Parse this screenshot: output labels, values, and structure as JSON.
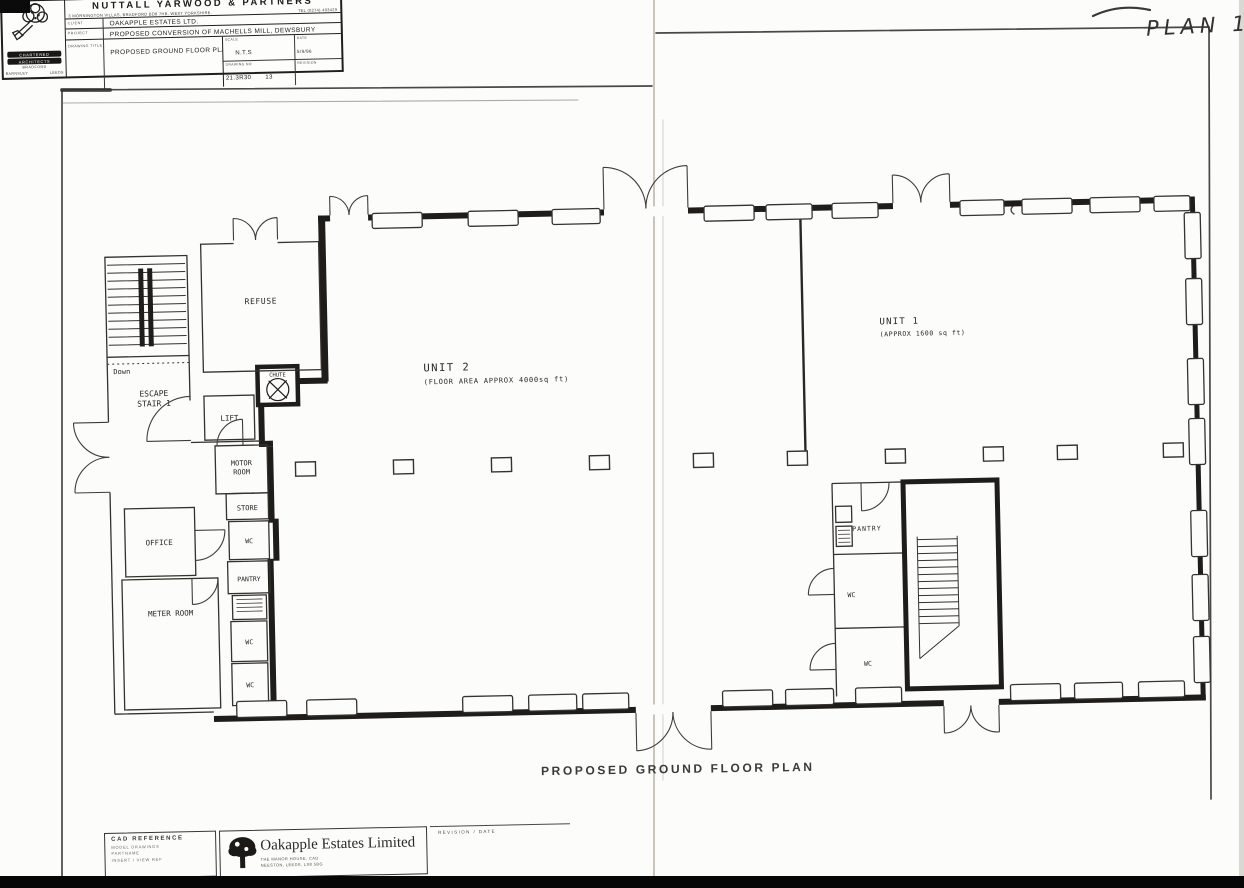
{
  "sheet": {
    "plan_ref": "PLAN 1",
    "caption": "PROPOSED GROUND FLOOR PLAN"
  },
  "plan": {
    "unit2_name": "UNIT 2",
    "unit2_area": "(FLOOR AREA APPROX 4000sq ft)",
    "unit1_name": "UNIT 1",
    "unit1_area": "(APPROX 1600 sq ft)",
    "refuse": "REFUSE",
    "chute": "CHUTE",
    "lift": "LIFT",
    "motor1": "MOTOR",
    "motor2": "ROOM",
    "store": "STORE",
    "wc": "WC",
    "pantry": "PANTRY",
    "office": "OFFICE",
    "meter_room": "METER ROOM",
    "escape1": "ESCAPE",
    "escape2": "STAIR 1",
    "down": "Down"
  },
  "stamps": {
    "cad": {
      "title": "CAD REFERENCE",
      "line1": "MODEL DRAWINGS",
      "line2": "PARTNAME",
      "line3": "INSERT / VIEW REF"
    },
    "oakapple": {
      "name": "Oakapple Estates Limited",
      "addr1": "THE MANOR HOUSE, CAD",
      "addr2": "NEESTON, LEEDS, LS8 5BG"
    },
    "revision": "REVISION / DATE"
  },
  "titleblock": {
    "firm": "NUTTALL YARWOOD & PARTNERS",
    "address": "3 MORNINGTON VILLAS, BRADFORD BD8 7HB, WEST YORKSHIRE.",
    "tel": "TEL (0274) 493429",
    "client_label": "CLIENT",
    "client": "OAKAPPLE ESTATES LTD.",
    "project_label": "PROJECT",
    "project": "PROPOSED CONVERSION OF MACHELLS MILL, DEWSBURY",
    "title_label": "DRAWING TITLE",
    "title": "PROPOSED GROUND FLOOR PLAN",
    "scale_label": "SCALE",
    "scale": "N.T.S",
    "date_label": "DATE",
    "date": "5/9/96",
    "dwgno_label": "DRAWING NO",
    "dwgno": "21.3R30",
    "sheet_no": "13",
    "rev_label": "REVISION",
    "logo": {
      "l1": "CHARTERED",
      "l2": "ARCHITECTS",
      "city": "BRADFORD",
      "b1": "BARNSLEY",
      "b2": "LEEDS"
    }
  }
}
